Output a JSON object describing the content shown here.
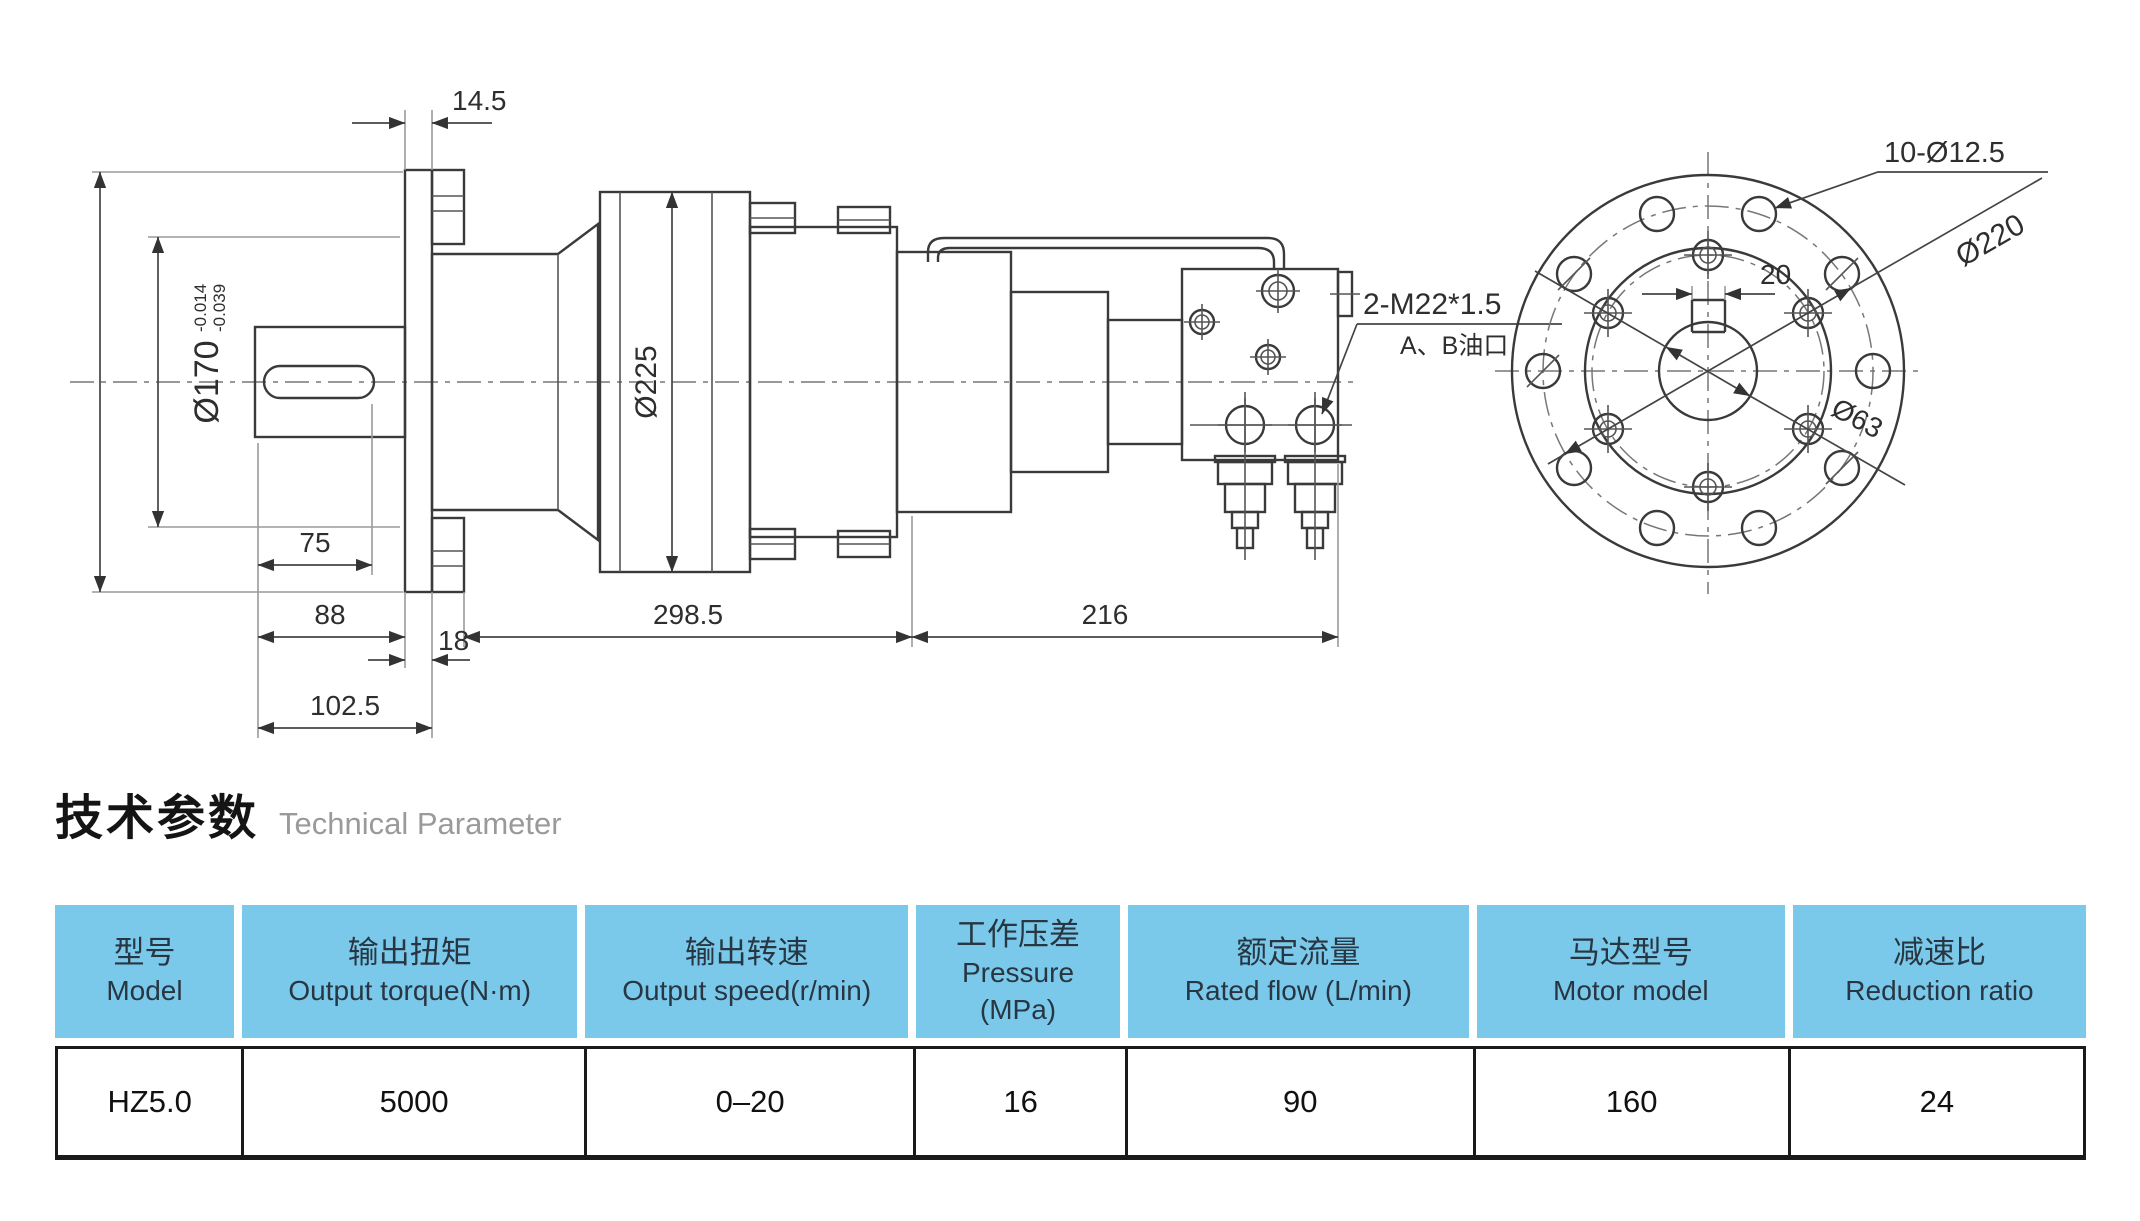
{
  "colors": {
    "header_bg": "#7bc9ea",
    "table_border": "#1a1a1a",
    "line": "#3a3a3a"
  },
  "title": {
    "zh": "技术参数",
    "en": "Technical Parameter"
  },
  "drawing": {
    "side_view": {
      "dim_14_5": "14.5",
      "shaft_dia": "Ø170",
      "shaft_tol_top": "-0.014",
      "shaft_tol_bot": "-0.039",
      "body_dia": "Ø225",
      "dim_75": "75",
      "dim_88": "88",
      "dim_18": "18",
      "dim_102_5": "102.5",
      "dim_298_5": "298.5",
      "dim_216": "216",
      "port_thread": "2-M22*1.5",
      "port_label": "A、B油口"
    },
    "end_view": {
      "bolt_holes": "10-Ø12.5",
      "bolt_circle_dia": "Ø220",
      "keyway_width": "20",
      "bore_dia": "Ø63"
    }
  },
  "table": {
    "headers": [
      {
        "zh": "型号",
        "en": "Model"
      },
      {
        "zh": "输出扭矩",
        "en": "Output torque(N·m)"
      },
      {
        "zh": "输出转速",
        "en": "Output speed(r/min)"
      },
      {
        "zh": "工作压差",
        "en": "Pressure",
        "en2": "(MPa)"
      },
      {
        "zh": "额定流量",
        "en": "Rated flow (L/min)"
      },
      {
        "zh": "马达型号",
        "en": "Motor model"
      },
      {
        "zh": "减速比",
        "en": "Reduction ratio"
      }
    ],
    "row": [
      "HZ5.0",
      "5000",
      "0–20",
      "16",
      "90",
      "160",
      "24"
    ]
  }
}
